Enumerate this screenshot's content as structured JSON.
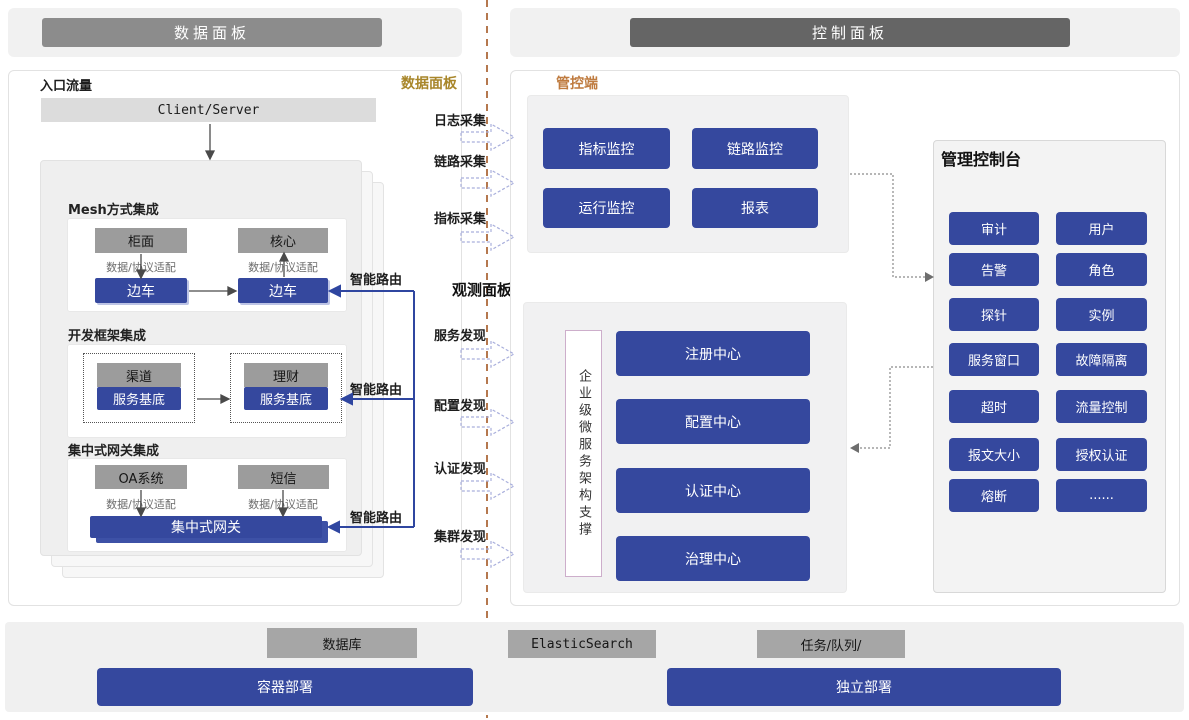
{
  "headers": {
    "left": "数据面板",
    "right": "控制面板"
  },
  "left_panel": {
    "corner_label": "入口流量",
    "panel_label": "数据面板",
    "entry_box": "Client/Server",
    "sections": [
      {
        "title": "Mesh方式集成",
        "top_left": "柜面",
        "top_right": "核心",
        "adapter": "数据/协议适配",
        "bottom_left": "边车",
        "bottom_right": "边车"
      },
      {
        "title": "开发框架集成",
        "top_left": "渠道",
        "top_right": "理财",
        "bottom_left": "服务基底",
        "bottom_right": "服务基底"
      },
      {
        "title": "集中式网关集成",
        "top_left": "OA系统",
        "top_right": "短信",
        "adapter": "数据/协议适配",
        "gateway": "集中式网关"
      }
    ],
    "smart_route": "智能路由"
  },
  "middle": {
    "collect": [
      "日志采集",
      "链路采集",
      "指标采集"
    ],
    "observe_label": "观测面板",
    "discover": [
      "服务发现",
      "配置发现",
      "认证发现",
      "集群发现"
    ]
  },
  "control": {
    "top_label": "管控端",
    "monitors": [
      "指标监控",
      "链路监控",
      "运行监控",
      "报表"
    ],
    "support_vertical": "企业级微服务架构支撑",
    "centers": [
      "注册中心",
      "配置中心",
      "认证中心",
      "治理中心"
    ],
    "console": {
      "title": "管理控制台",
      "buttons": [
        "审计",
        "用户",
        "告警",
        "角色",
        "探针",
        "实例",
        "服务窗口",
        "故障隔离",
        "超时",
        "流量控制",
        "报文大小",
        "授权认证",
        "熔断",
        "......"
      ]
    }
  },
  "bottom": {
    "infra": [
      "数据库",
      "ElasticSearch",
      "任务/队列/"
    ],
    "deploy_left": "容器部署",
    "deploy_right": "独立部署"
  },
  "colors": {
    "accent_blue": "#35489E",
    "header_gray": "#8C8C8C",
    "header_dark_gray": "#656565",
    "gold_label": "#A8862A",
    "orange_label": "#BF7B3F",
    "divider_brown": "#B5784E",
    "gray_box": "#9C9C9C",
    "lavender_arrow": "#A9AFDC"
  }
}
